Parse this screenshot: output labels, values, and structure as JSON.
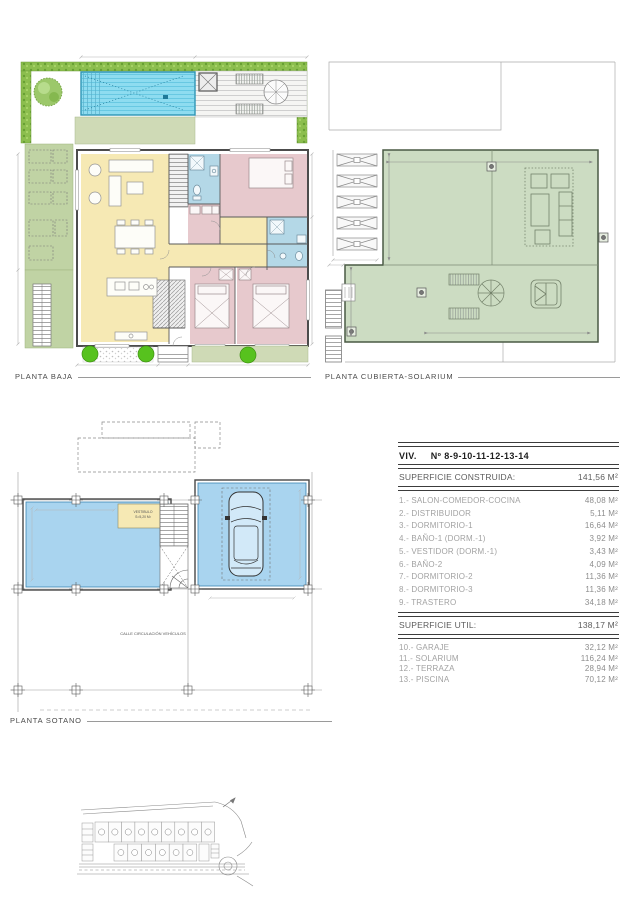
{
  "colors": {
    "hedge": "#8cbe4e",
    "garden": "#c0d3a4",
    "terrace": "#cfdab6",
    "pool": "#8edcf0",
    "pool_edge": "#2d95b5",
    "living": "#f6e9b4",
    "bedroom": "#e7c9cd",
    "bath": "#b4d8e7",
    "solarium": "#ccdcc2",
    "basement": "#a9d4ef",
    "wall": "#4c4c4c",
    "line": "#8f8f8f",
    "dim": "#b5b5b5",
    "text": "#4a4a4a",
    "muted": "#a2a2a2"
  },
  "plans": {
    "planta_baja": {
      "label": "PLANTA BAJA"
    },
    "planta_cubierta": {
      "label": "PLANTA CUBIERTA-SOLARIUM"
    },
    "planta_sotano": {
      "label": "PLANTA SOTANO",
      "street_label": "CALLE CIRCULACIÓN VEHÍCULOS",
      "vestibule_label": "VESTIBULO",
      "vestibule_area": "S=5,20 M²"
    }
  },
  "surface_table": {
    "title_prefix": "VIV.",
    "title_number": "Nº 8-9-10-11-12-13-14",
    "built_label": "SUPERFICIE CONSTRUIDA:",
    "built_value": "141,56 M²",
    "rooms": [
      {
        "label": "1.- SALON-COMEDOR-COCINA",
        "value": "48,08 M²"
      },
      {
        "label": "2.- DISTRIBUIDOR",
        "value": "5,11 M²"
      },
      {
        "label": "3.- DORMITORIO-1",
        "value": "16,64 M²"
      },
      {
        "label": "4.- BAÑO-1 (DORM.-1)",
        "value": "3,92 M²"
      },
      {
        "label": "5.- VESTIDOR (DORM.-1)",
        "value": "3,43 M²"
      },
      {
        "label": "6.- BAÑO-2",
        "value": "4,09 M²"
      },
      {
        "label": "7.- DORMITORIO-2",
        "value": "11,36 M²"
      },
      {
        "label": "8.- DORMITORIO-3",
        "value": "11,36 M²"
      },
      {
        "label": "9.- TRASTERO",
        "value": "34,18 M²"
      }
    ],
    "useful_label": "SUPERFICIE UTIL:",
    "useful_value": "138,17 M²",
    "extras": [
      {
        "label": "10.- GARAJE",
        "value": "32,12 M²"
      },
      {
        "label": "11.- SOLARIUM",
        "value": "116,24 M²"
      },
      {
        "label": "12.- TERRAZA",
        "value": "28,94 M²"
      },
      {
        "label": "13.- PISCINA",
        "value": "70,12 M²"
      }
    ]
  },
  "site_plan": {
    "plots_top_row": 9,
    "plots_bottom_row": 6
  }
}
